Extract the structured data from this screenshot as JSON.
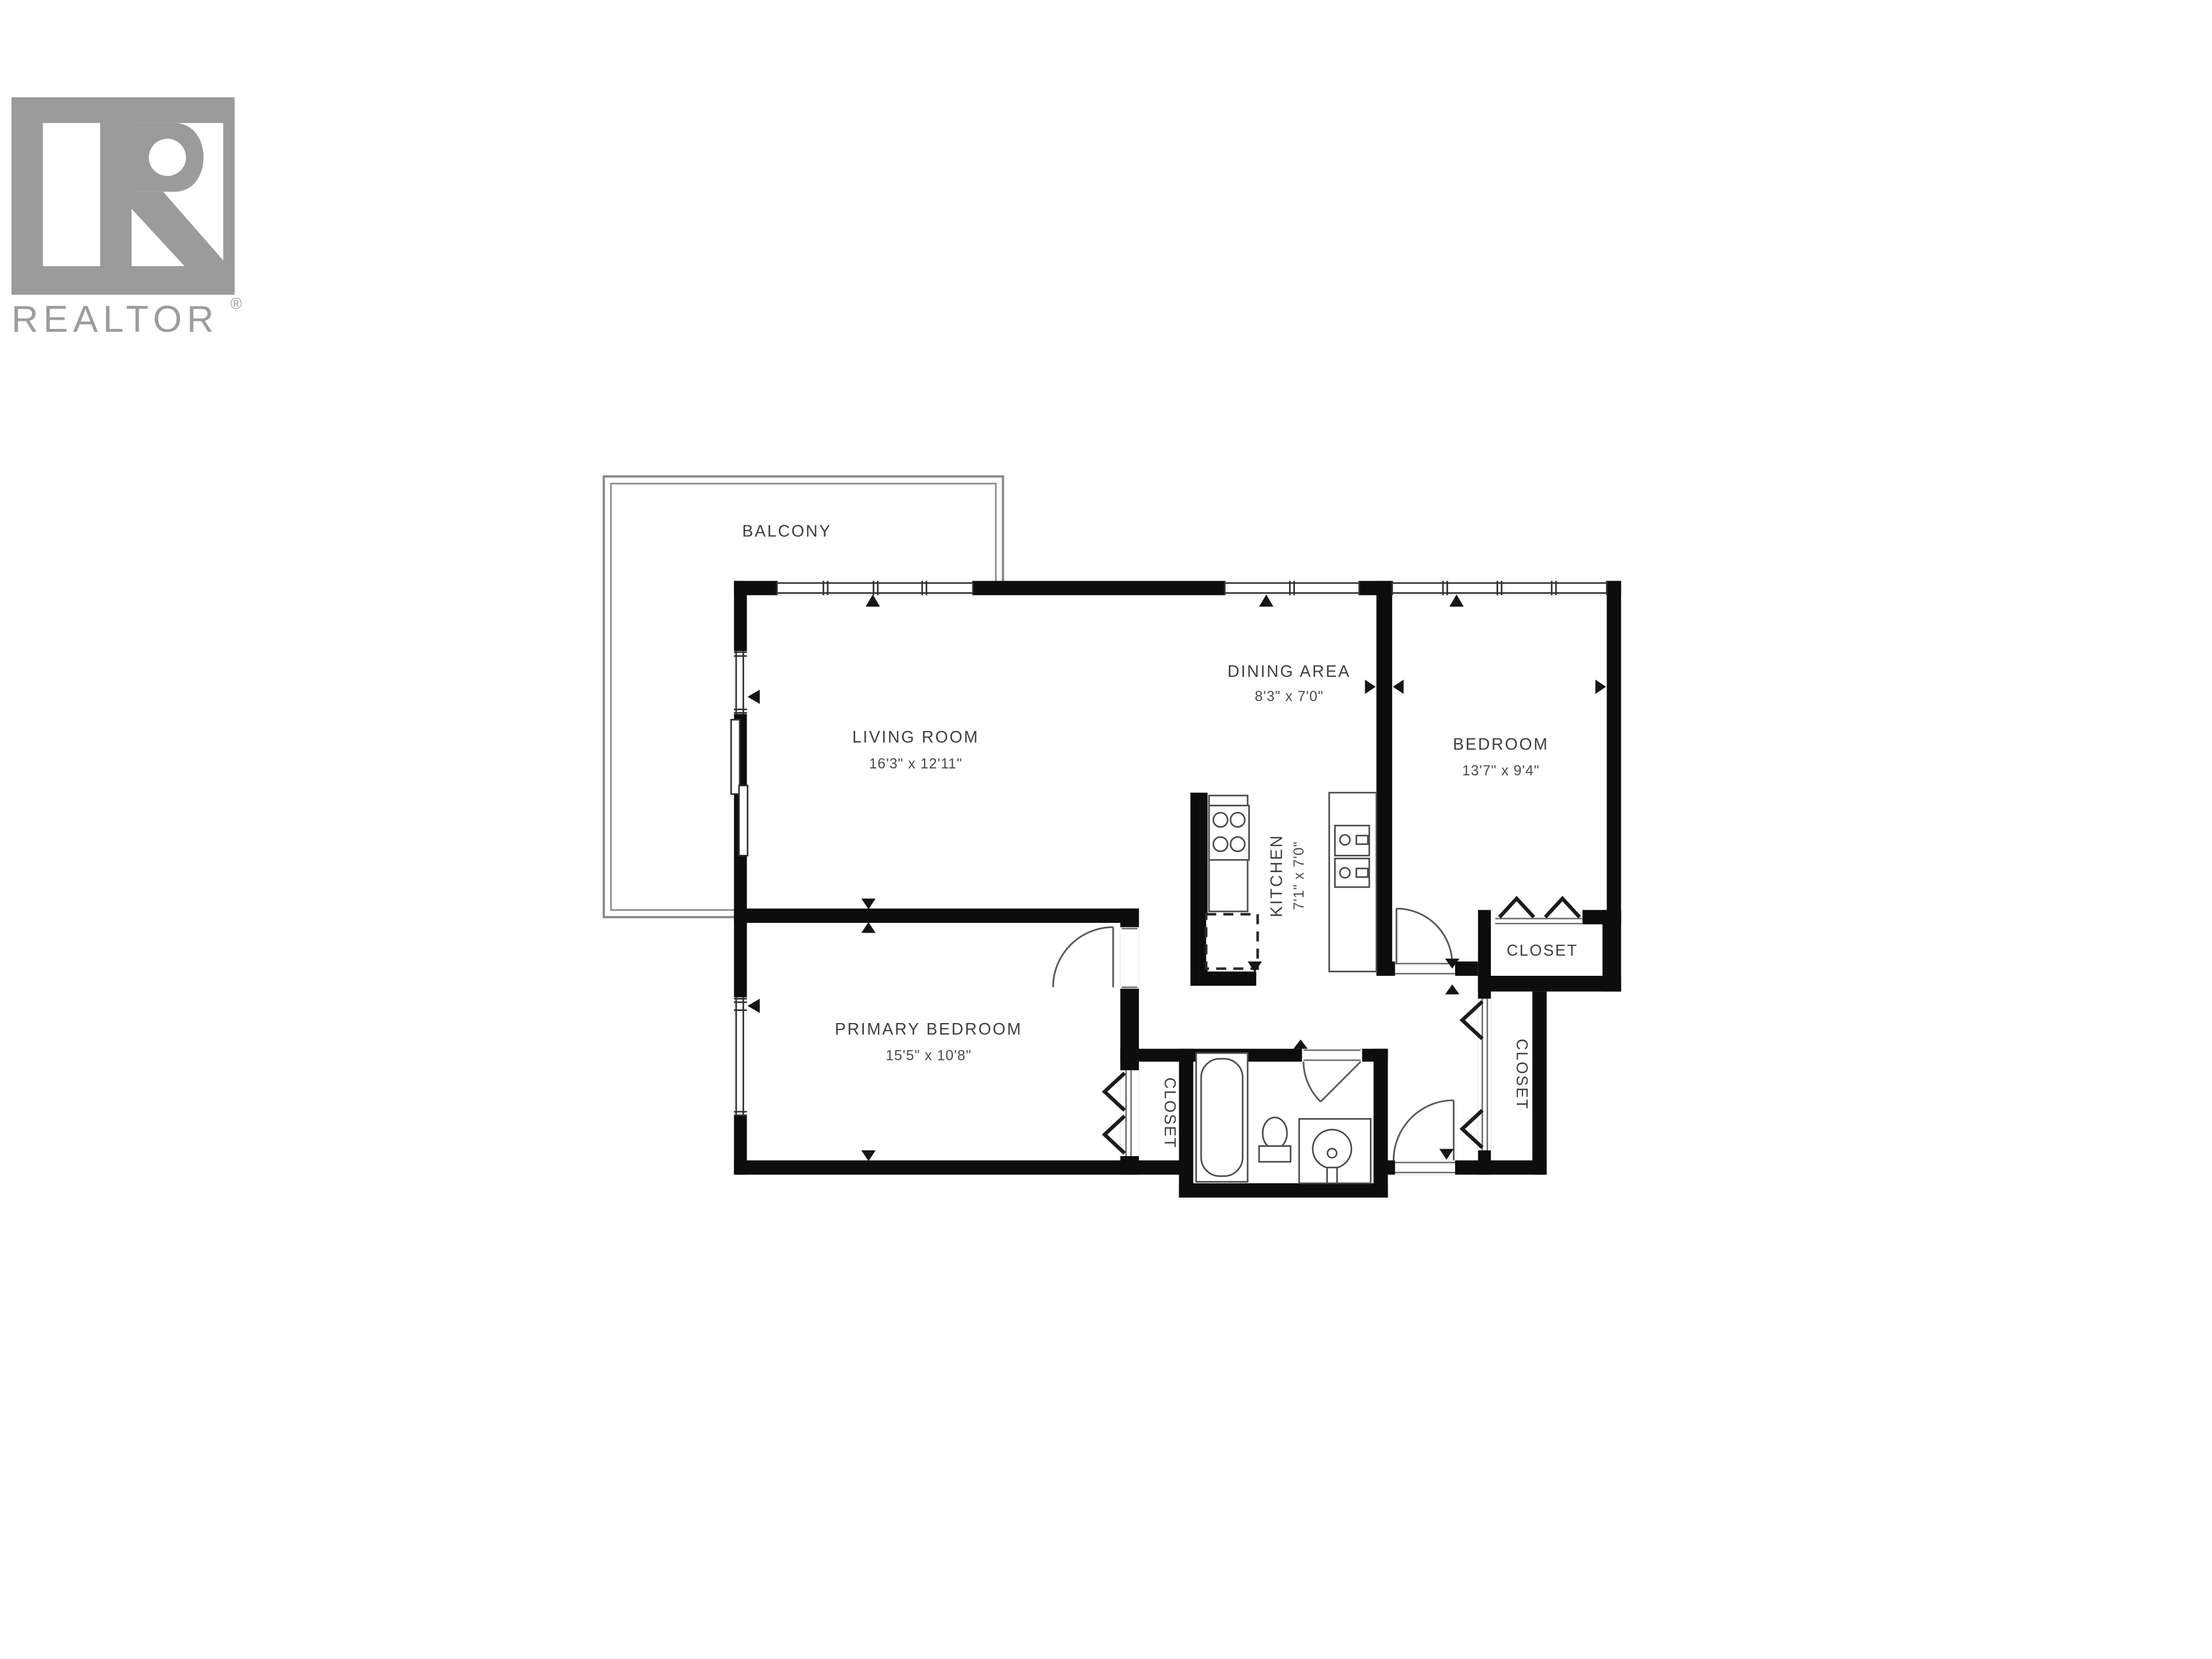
{
  "logo": {
    "brand": "REALTOR",
    "registered": "®"
  },
  "colors": {
    "wall": "#0d0d0d",
    "logo_gray": "#9b9b9b",
    "label_text": "#3e3e3e",
    "fixture_line": "#4a4a4a",
    "balcony_line": "#8a8a8a",
    "background": "#ffffff"
  },
  "rooms": {
    "balcony": {
      "name": "BALCONY"
    },
    "living": {
      "name": "LIVING ROOM",
      "dims": "16'3\" x 12'11\""
    },
    "dining": {
      "name": "DINING AREA",
      "dims": "8'3\" x 7'0\""
    },
    "bedroom": {
      "name": "BEDROOM",
      "dims": "13'7\" x 9'4\""
    },
    "kitchen": {
      "name": "KITCHEN",
      "dims": "7'1\" x 7'0\""
    },
    "primary": {
      "name": "PRIMARY BEDROOM",
      "dims": "15'5\" x 10'8\""
    },
    "closet_bedroom": {
      "name": "CLOSET"
    },
    "closet_hall": {
      "name": "CLOSET"
    },
    "closet_primary": {
      "name": "CLOSET"
    }
  }
}
